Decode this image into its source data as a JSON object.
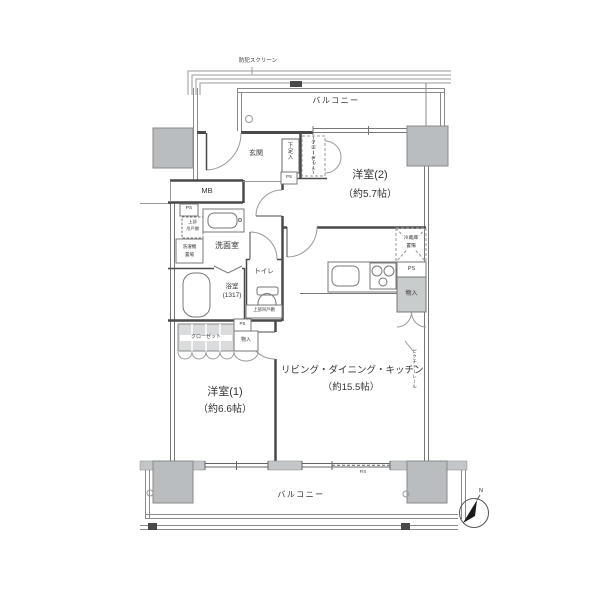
{
  "colors": {
    "wall": "#4a4a4a",
    "thin_line": "#8a8a8a",
    "pillar_fill": "#b9bdbf",
    "storage_fill": "#c9cccd",
    "closet_hatch": "#d9dbdc",
    "text": "#333333",
    "background": "#ffffff"
  },
  "labels": {
    "security_screen": "防犯スクリーン",
    "balcony": "バルコニー",
    "entrance": {
      "name": "玄関",
      "shoe_cabinet": "下足入",
      "ps": "PS"
    },
    "bedroom2": {
      "name": "洋室(2)",
      "size": "（約5.7帖）",
      "closet": "クローゼット"
    },
    "utility": {
      "mb": "MB",
      "ps": "PS",
      "upper_cabinet_l1": "上部",
      "upper_cabinet_l2": "吊戸棚",
      "washer_l1": "洗濯機",
      "washer_l2": "置場"
    },
    "washroom": {
      "name": "洗面室",
      "bath_name": "浴室",
      "bath_size": "(1317)",
      "toilet": "トイレ",
      "toilet_cabinet": "上部吊戸棚"
    },
    "kitchen": {
      "fridge_l1": "冷蔵庫",
      "fridge_l2": "置場",
      "ps": "PS",
      "storage": "物入"
    },
    "ldk": {
      "name": "リビング・ダイニング・キッチン",
      "size": "（約15.5帖）",
      "picture_rail": "ピクチャーレール"
    },
    "bedroom1": {
      "name": "洋室(1)",
      "size": "（約6.6帖）",
      "closet": "クローゼット",
      "storage": "物入",
      "ps": "PS"
    },
    "fix": "FIX",
    "compass_n": "N"
  }
}
